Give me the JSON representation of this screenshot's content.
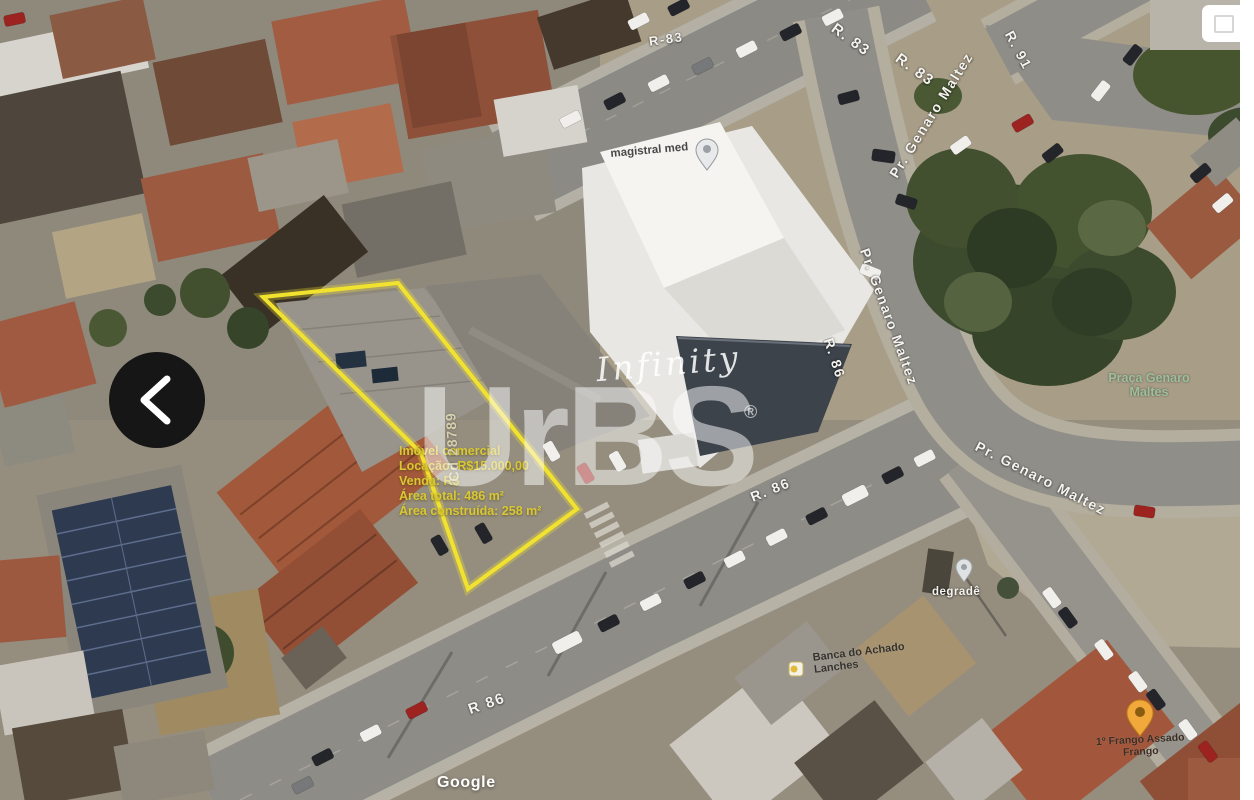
{
  "viewer": {
    "google_attribution": "Google",
    "icons": {
      "prev": "chevron-left-icon",
      "corner": "map-control-icon"
    }
  },
  "watermark": {
    "script_text": "Infinity",
    "brand_text": "UrBS",
    "registered_mark": "®"
  },
  "property": {
    "code": "Cd 28789",
    "outline_color": "#f2e230",
    "text_color": "#d9c833",
    "info_lines": [
      "Imóvel comercial",
      "Locação: R$15.000,00",
      "Venda: R$",
      "Área total: 486 m²",
      "Área construída: 258 m²"
    ]
  },
  "map_labels": {
    "roads": [
      {
        "text": "R-83"
      },
      {
        "text": "R. 83"
      },
      {
        "text": "R. 83"
      },
      {
        "text": "R. 91"
      },
      {
        "text": "Pr. Genaro Maltez"
      },
      {
        "text": "Pr. Genaro Maltez"
      },
      {
        "text": "R. 86"
      },
      {
        "text": "R. 86"
      },
      {
        "text": "R 86"
      },
      {
        "text": "Pr. Genaro Maltez"
      }
    ],
    "pois": {
      "park": {
        "line1": "Praça Genaro",
        "line2": "Maltes",
        "color": "#9dbf9b"
      },
      "clinic": {
        "text": "magistral med"
      },
      "store": {
        "line1": "Banca do Achado",
        "line2": "Lanches"
      },
      "salon": {
        "text": "degradê"
      },
      "restaurant": {
        "line1": "1º Frango Assado",
        "line2": "Frango"
      }
    }
  }
}
